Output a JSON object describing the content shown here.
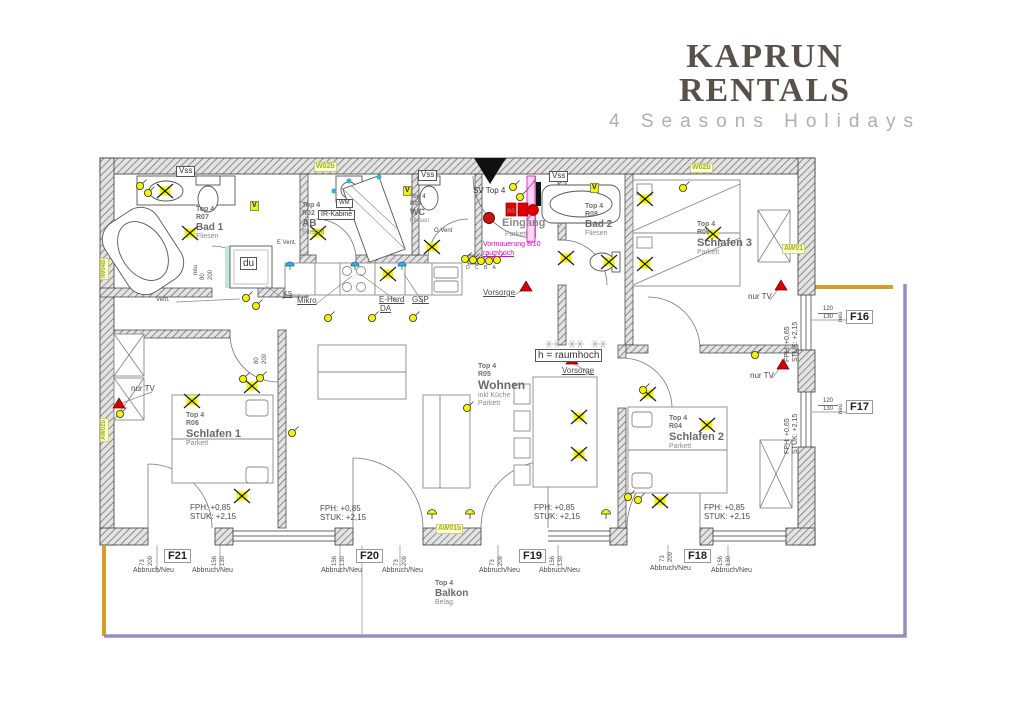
{
  "brand": {
    "title": "KAPRUN RENTALS",
    "subtitle": "4 Seasons Holidays"
  },
  "rooms": {
    "bad1": {
      "unit": "Top 4",
      "nr": "R07",
      "name": "Bad 1",
      "floor": "Fliesen"
    },
    "ab": {
      "unit": "Top 4",
      "nr": "R02",
      "name": "AB",
      "floor": "Fliesen"
    },
    "wc": {
      "unit": "Top 4",
      "nr": "R03",
      "name": "WC",
      "floor": "Fliesen"
    },
    "eingang": {
      "nr": "R01",
      "name": "Eingang",
      "floor": "Parkett"
    },
    "bad2": {
      "unit": "Top 4",
      "nr": "R08",
      "name": "Bad 2",
      "floor": "Fliesen"
    },
    "schlafen3": {
      "unit": "Top 4",
      "nr": "R09",
      "name": "Schlafen 3",
      "floor": "Parkett"
    },
    "schlafen1": {
      "unit": "Top 4",
      "nr": "R06",
      "name": "Schlafen 1",
      "floor": "Parkett"
    },
    "wohnen": {
      "unit": "Top 4",
      "nr": "R05",
      "name": "Wohnen",
      "extra": "inkl Küche",
      "floor": "Parkett"
    },
    "schlafen2": {
      "unit": "Top 4",
      "nr": "R04",
      "name": "Schlafen 2",
      "floor": "Parkett"
    },
    "balkon": {
      "unit": "Top 4",
      "name": "Balkon",
      "floor": "Belag"
    }
  },
  "windows": {
    "f16": "F16",
    "f17": "F17",
    "f18": "F18",
    "f19": "F19",
    "f20": "F20",
    "f21": "F21"
  },
  "wall_tags": {
    "vss": "Vss",
    "w02b": "W02b",
    "v": "V",
    "iw04b": "IW04B",
    "aw02b": "AW02b",
    "aw01": "AW01",
    "aw01b": "AW01b"
  },
  "annotations": {
    "sv_top4": "SV Top 4",
    "nur_tv": "nur TV",
    "vorsorge": "Vorsorge",
    "raumhoch_box": "h = raumhoch",
    "vormauerung": "Vormauerung 8/10",
    "vormauerung2": "raumhoch",
    "abbruch_neu": "Abbruch/Neu",
    "fph85": "FPH:  +0,85",
    "stuk215": "STUK: +2,15",
    "fph65": "FPH: +0,65",
    "du": "du",
    "wm": "WM",
    "ir_kabine": "IR-Kabine",
    "ks": "KS",
    "mikro": "Mikro",
    "e_herd": "E-Herd",
    "da": "DA",
    "gsp": "GSP",
    "vent": "Vent.",
    "o_vent": "O Vent",
    "e_vent": "E Vent.",
    "letters_dcba": "D C B A",
    "neu": "neu"
  },
  "dims": {
    "d73": "73",
    "d209": "209",
    "d156": "156",
    "d130": "130",
    "d120": "120",
    "d80": "80",
    "d200": "200"
  },
  "colors": {
    "wall": "#6f6f6f",
    "symbol_yellow": "#f4f400",
    "tag_green": "#a9b400",
    "magenta": "#e400c8",
    "red": "#cc1111",
    "cyan": "#2fb3dc",
    "balcony_orange": "#d99b2a",
    "railing_slate": "#938fc0"
  }
}
